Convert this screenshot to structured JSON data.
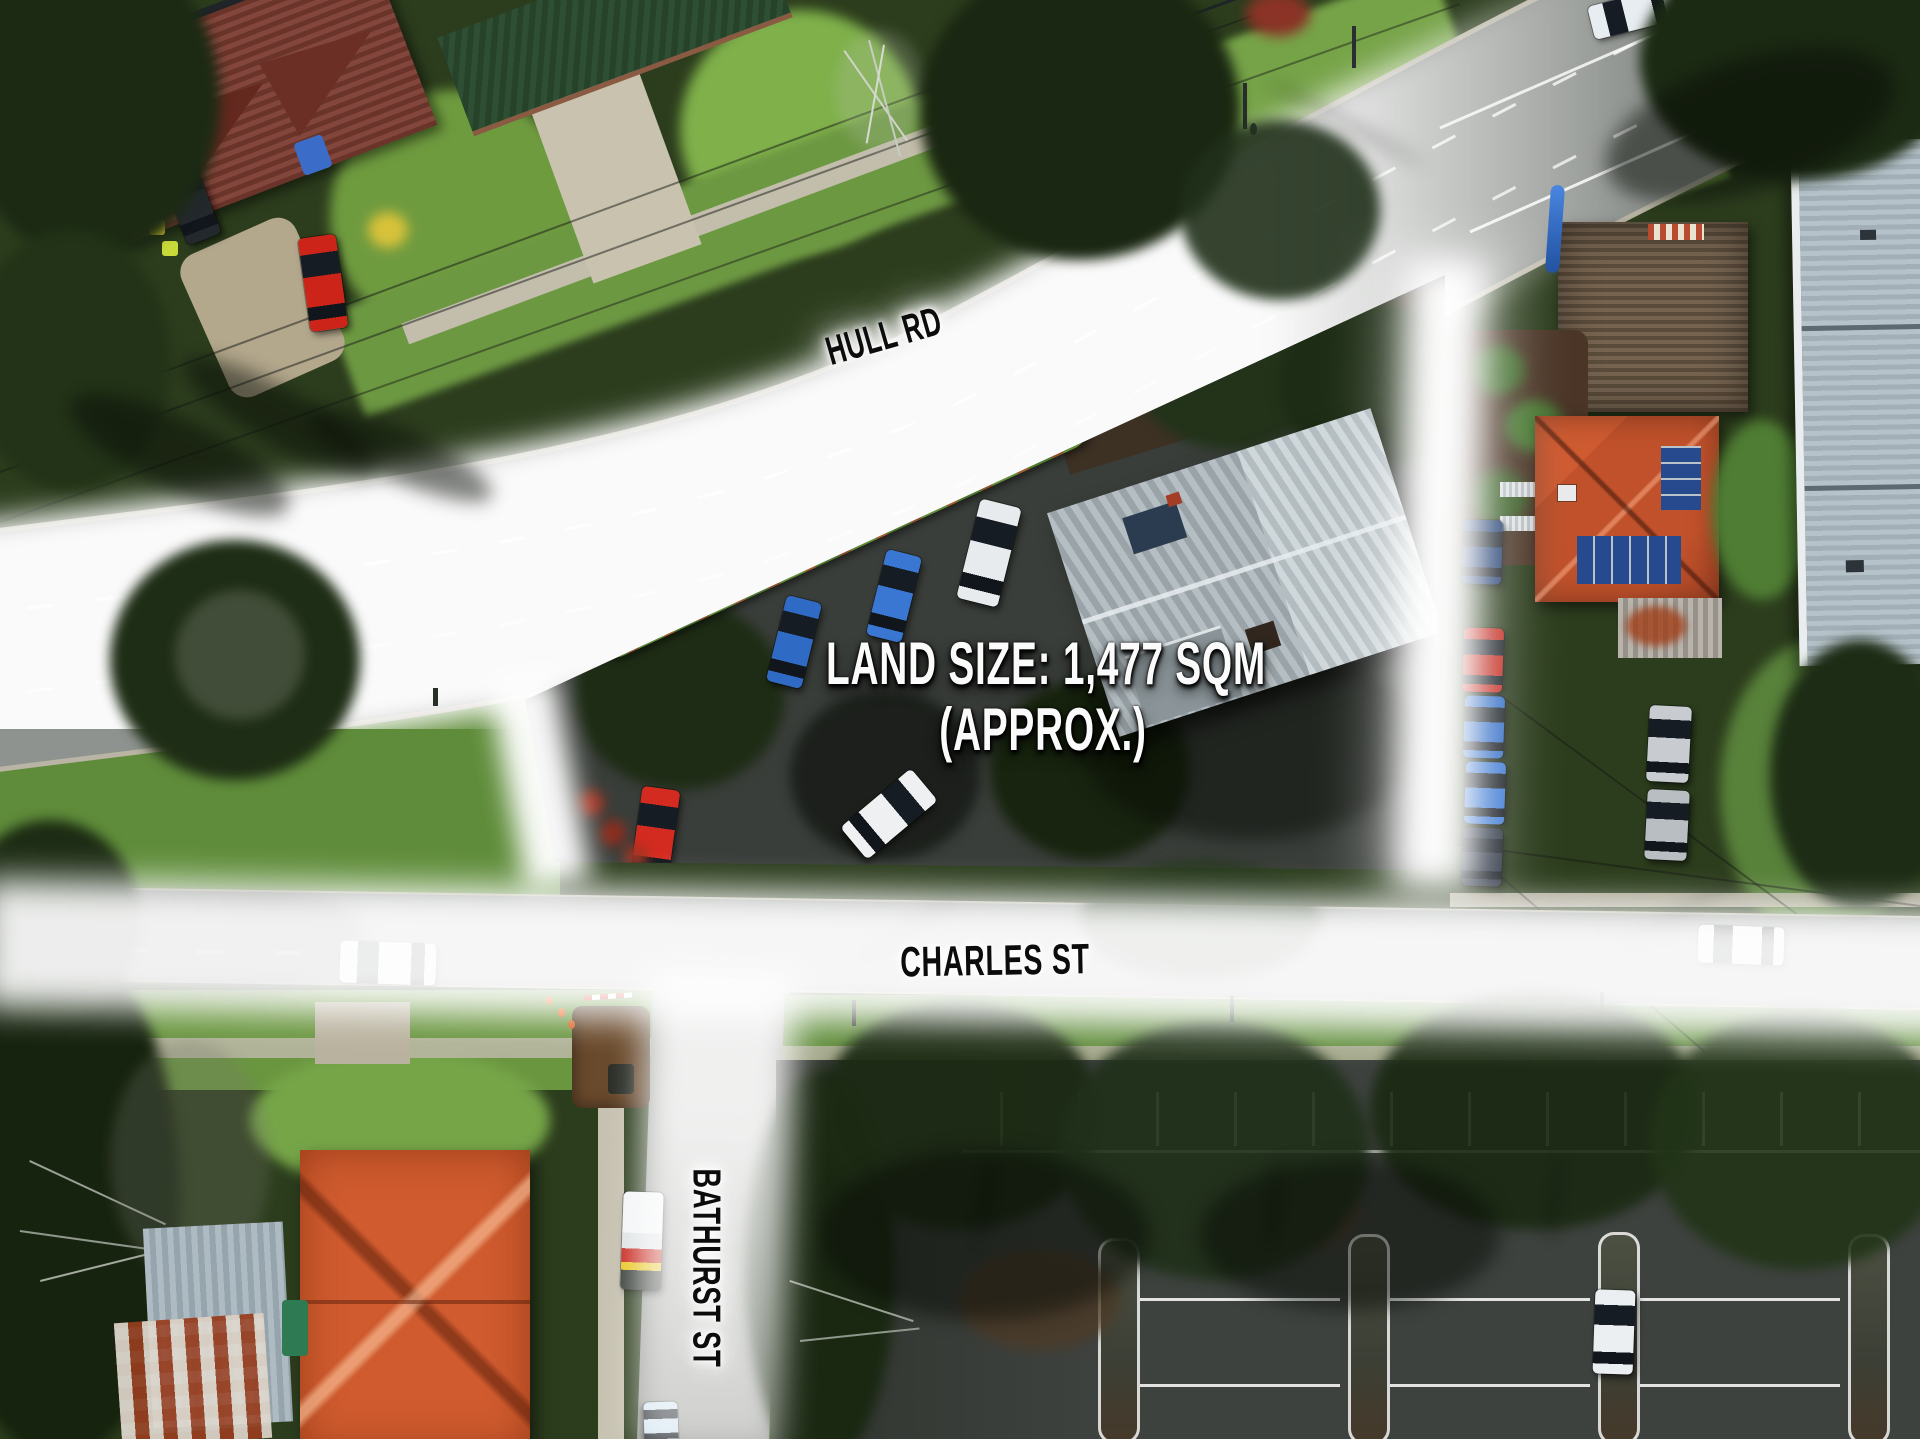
{
  "image_type": "aerial-drone-property-photo",
  "streets": {
    "hull": "HULL RD",
    "charles": "CHARLES ST",
    "bathurst": "BATHURST ST"
  },
  "land_annotation": {
    "line1": "LAND SIZE: 1,477 SQM",
    "line2": "(APPROX.)"
  },
  "colors": {
    "boundary_glow": "#ffffff",
    "street_label_text": "#0c0c0c",
    "land_label_text": "#fbfbfb"
  }
}
